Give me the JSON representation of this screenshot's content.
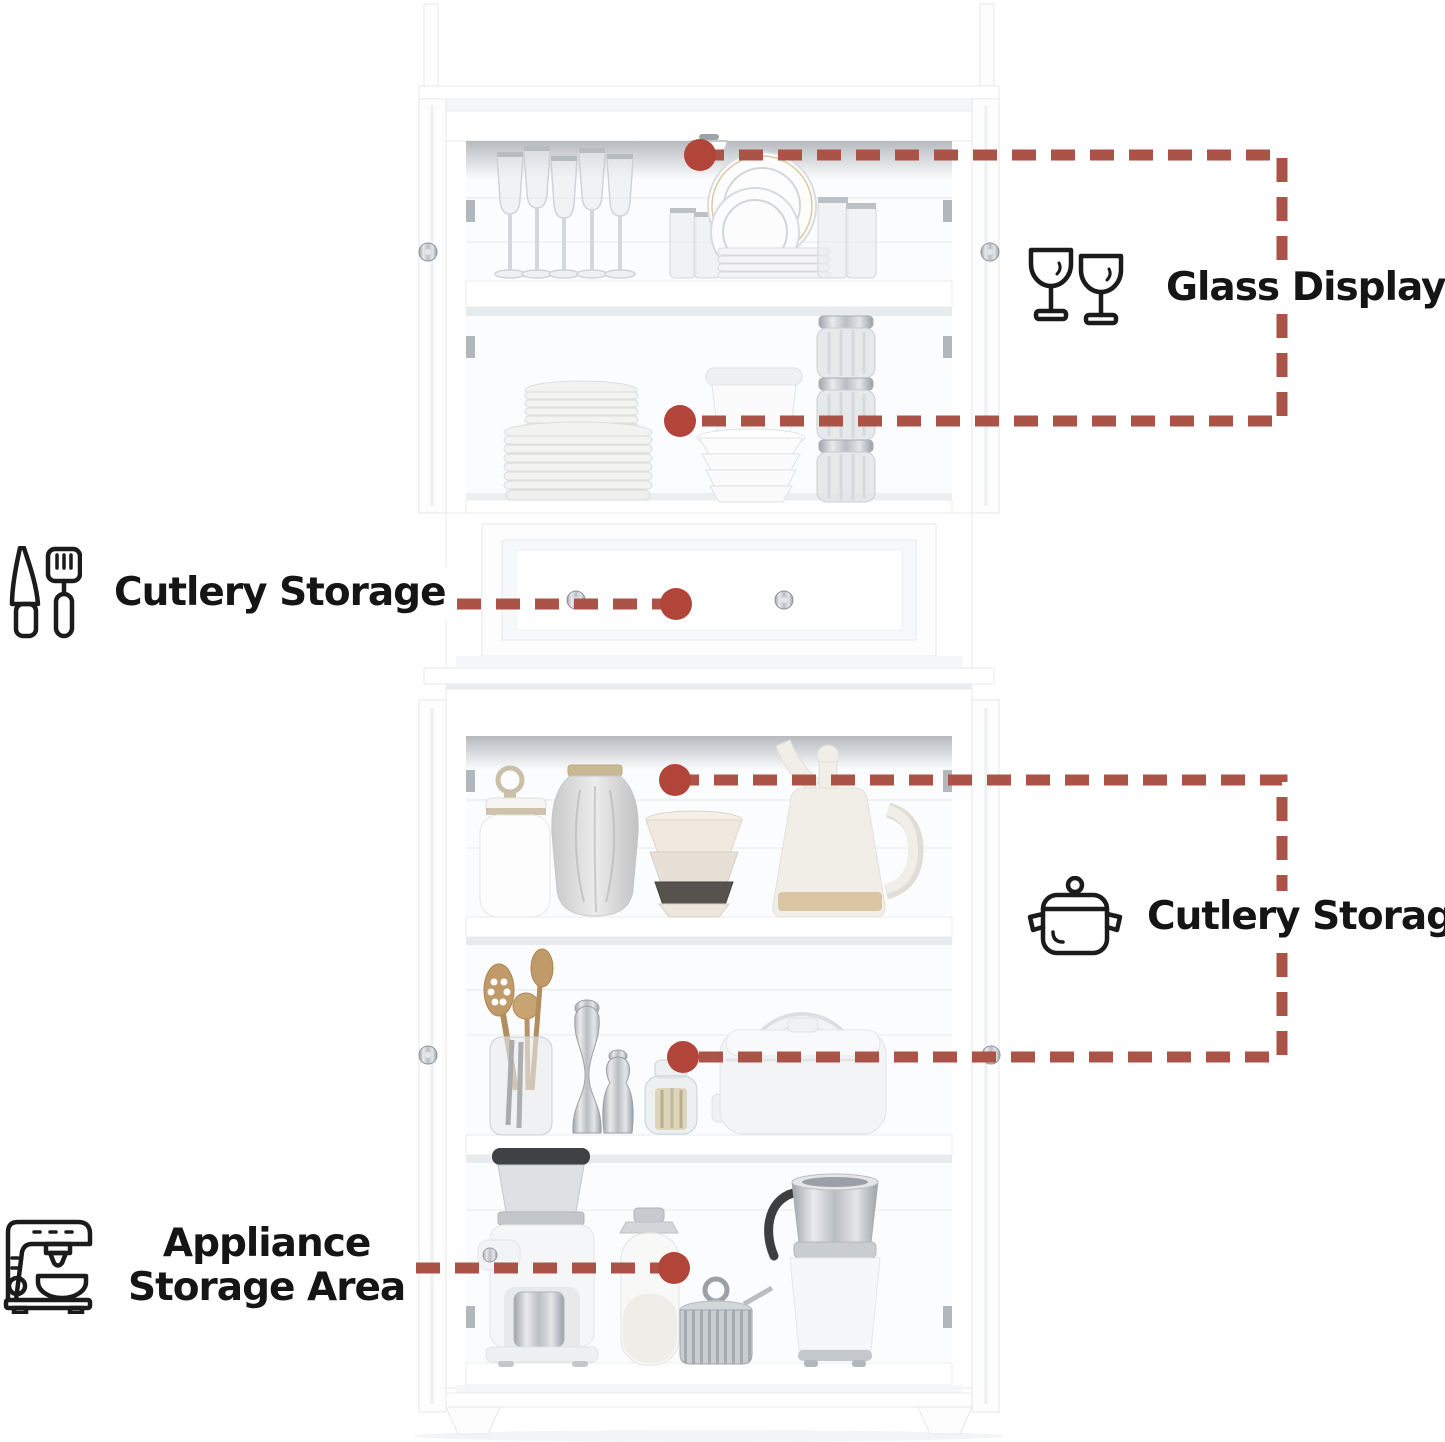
{
  "page": {
    "width": 1445,
    "height": 1442,
    "background": "#ffffff"
  },
  "annotations": {
    "glass_display": {
      "label": "Glass Display",
      "icon": "wine-glasses-icon"
    },
    "cutlery_storage_left": {
      "label": "Cutlery Storage",
      "icon": "knife-spatula-icon"
    },
    "cutlery_storage_right": {
      "label": "Cutlery Storage",
      "icon": "cooking-pot-icon"
    },
    "appliance_storage": {
      "label_line1": "Appliance",
      "label_line2": "Storage Area",
      "icon": "coffee-machine-icon"
    }
  },
  "colors": {
    "callout_dash": "#ab5347",
    "callout_dot": "#b2453a",
    "label_text": "#151515",
    "icon_stroke": "#1b1b1b",
    "cabinet_white": "#ffffff"
  },
  "product": {
    "name": "white-kitchen-hutch-cabinet",
    "sections": {
      "glass_display_top": {
        "contents": [
          "wine-glasses",
          "tumblers",
          "leaning-plates",
          "plate-stack",
          "lidded-container",
          "bowl-stack",
          "glass-jars"
        ]
      },
      "middle_drawer": {
        "contents": [
          "cutlery-drawer"
        ]
      },
      "lower_cupboard": {
        "contents": [
          "canister-jar",
          "patterned-vase",
          "nesting-bowls",
          "teapot",
          "utensil-jar",
          "pepper-mills",
          "small-jar",
          "egg-cooker",
          "coffee-grinder",
          "milk-bottle",
          "sugar-bowl",
          "milk-frother"
        ]
      }
    }
  }
}
